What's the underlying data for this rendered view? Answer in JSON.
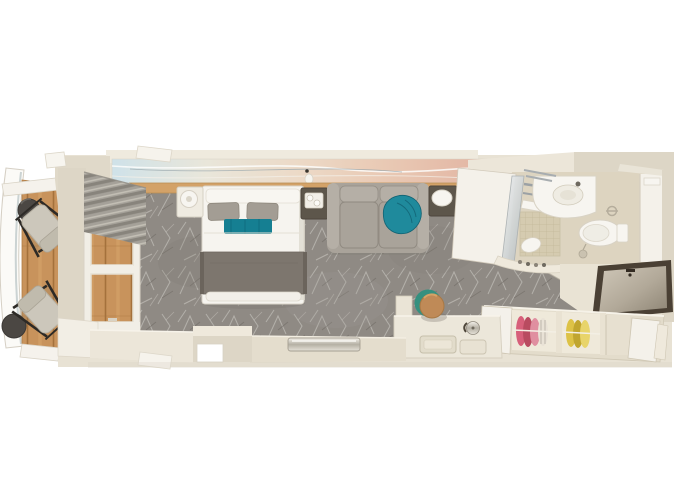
{
  "scene": {
    "objects": [
      "hull-railing",
      "balcony",
      "balcony-wood-floor",
      "balcony-divider",
      "balcony-chair",
      "balcony-side-table",
      "window-wall",
      "window",
      "curtains",
      "carpet",
      "artwork-mural",
      "headboard-shelf",
      "reading-light",
      "bed",
      "pillow",
      "teal-runner",
      "bed-throw",
      "nightstand",
      "table-lamp",
      "cup-tray",
      "sofa",
      "sofa-throw-blanket",
      "side-table",
      "bathroom",
      "shower",
      "shower-glass",
      "shower-floor",
      "sink-counter",
      "sink-basin",
      "faucet",
      "toilet",
      "toilet-paper-holder",
      "toilet-brush",
      "bath-counter",
      "toiletries-ledge",
      "entry-floor",
      "entry-door",
      "door-handle",
      "wardrobe",
      "wardrobe-door",
      "clothes-pink",
      "clothes-yellow",
      "vanity-desk",
      "desk-tray",
      "kettle",
      "vanity-stool",
      "wall-stub",
      "threshold-strip",
      "bottom-wall",
      "top-wall",
      "right-wall",
      "window-sill"
    ]
  },
  "palette": {
    "page_bg": "#ffffff",
    "wall_cream": "#ddd6c6",
    "wall_cream_light": "#ece6d9",
    "wall_white": "#f4f1ea",
    "top_wall_strip": "#efeade",
    "interior_base": "#e8e2d4",
    "floor_entry": "#e9e3d4",
    "carpet_base": "#8f8a84",
    "carpet_dark": "#7e7973",
    "carpet_stroke": "#d8d5d0",
    "balcony_wood": "#c8935c",
    "wood_gap": "#a4713c",
    "wood_streak": "#d8a86b",
    "headboard_wood": "#d3a268",
    "hull_white": "#fbfaf7",
    "glass_rail": "#c2cbcd",
    "chair_fabric": "#ccc7bb",
    "chair_cushion": "#c0bbad",
    "chair_frame": "#2d2a26",
    "balcony_table": "#4b4743",
    "curtain_gray": "#a5a199",
    "curtain_dark": "#88847c",
    "curtain_lite": "#c2beb4",
    "art_blue": "#cfe2e9",
    "art_cream": "#e9e6da",
    "art_peach": "#ecd9c6",
    "art_pink": "#e2b4a2",
    "bed_white": "#f6f4ef",
    "bed_shadow": "#dcd7cc",
    "pillow_gray": "#a39d94",
    "runner_teal": "#157f92",
    "throw_gray": "#7d766e",
    "throw_edge": "#6b645c",
    "sofa_gray": "#a9a39a",
    "sofa_light": "#b5afa6",
    "teal_throw": "#1f8a9c",
    "furniture_dark": "#5d564b",
    "lamp_white": "#f7f5f0",
    "bath_floor": "#ddd4c0",
    "tile_beige": "#d5cbb0",
    "tile_line": "#c3b898",
    "fixture_white": "#f7f5f0",
    "fixture_shadow": "#d9d3c5",
    "chrome": "#9ba1a5",
    "door_frame": "#4a4034",
    "clothes_pink": "#d7607a",
    "clothes_pink_dark": "#b94b60",
    "clothes_pink_lite": "#e08fa0",
    "clothes_yellow": "#ddc246",
    "clothes_yellow_dark": "#c0a52f",
    "clothes_yellow_lite": "#e8d46a",
    "wardrobe_frame": "#e3dccb",
    "wardrobe_inside": "#efe9da",
    "desk_white": "#ece7da",
    "tray_fill": "#e2dccb",
    "stool_leather": "#bf8a57",
    "stool_teal": "#35907f",
    "metal_edge": "#a59f92"
  }
}
